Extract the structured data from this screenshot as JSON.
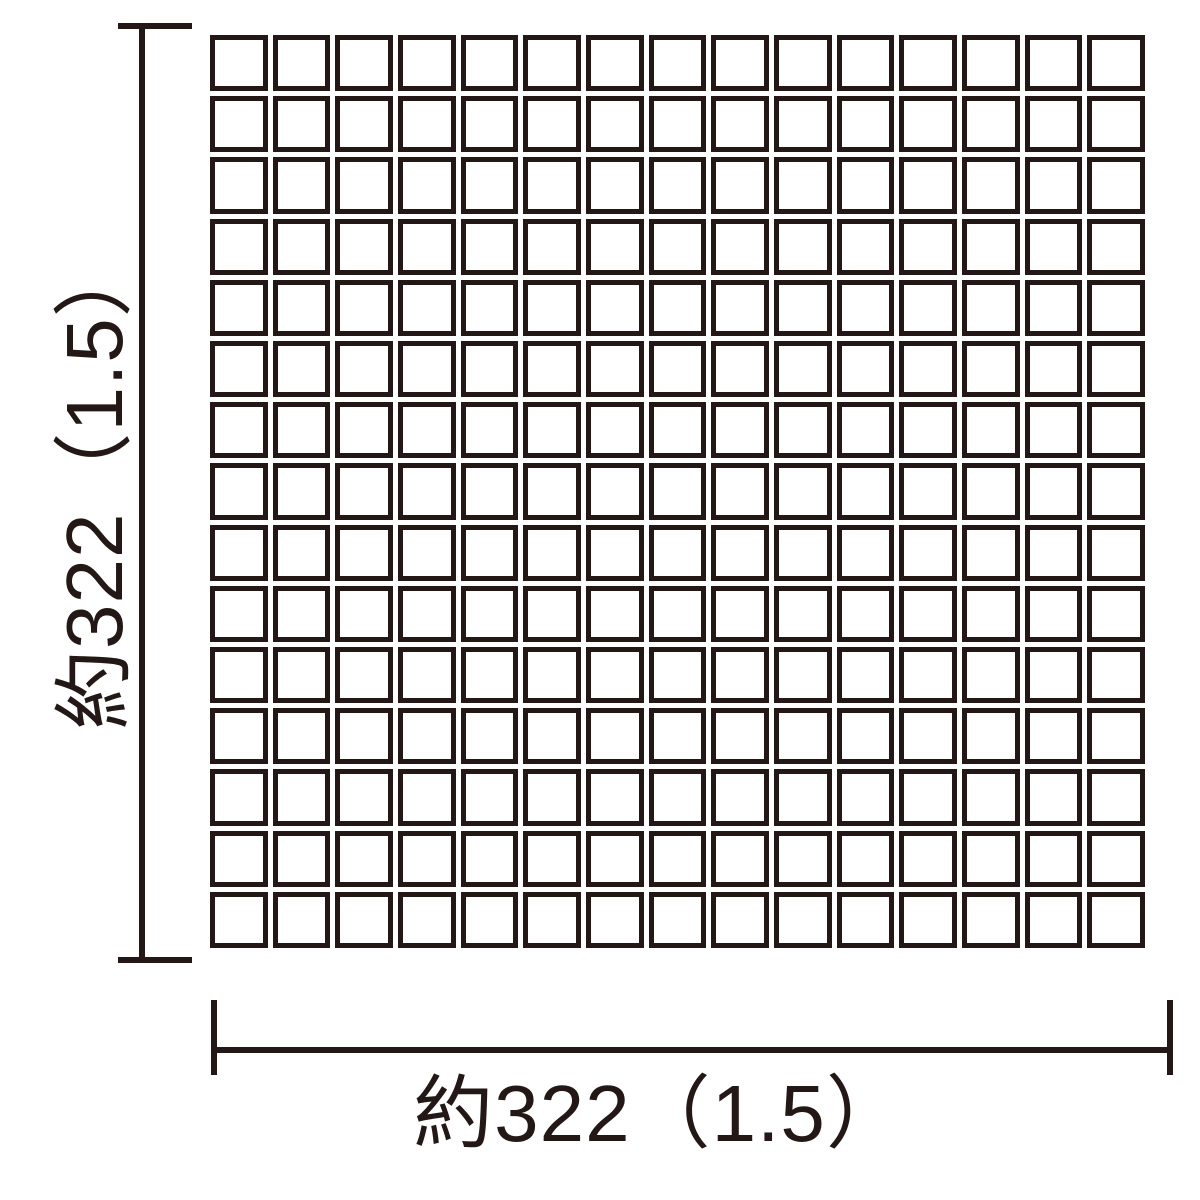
{
  "diagram": {
    "type": "tile-sheet-dimension-drawing",
    "background_color": "#ffffff",
    "line_color": "#231815",
    "mosaic": {
      "rows": 15,
      "cols": 15,
      "tile_border_color": "#231815",
      "tile_fill_color": "#ffffff"
    },
    "dimensions": {
      "height": {
        "label": "約322（1.5）"
      },
      "width": {
        "label": "約322（1.5）"
      }
    }
  }
}
